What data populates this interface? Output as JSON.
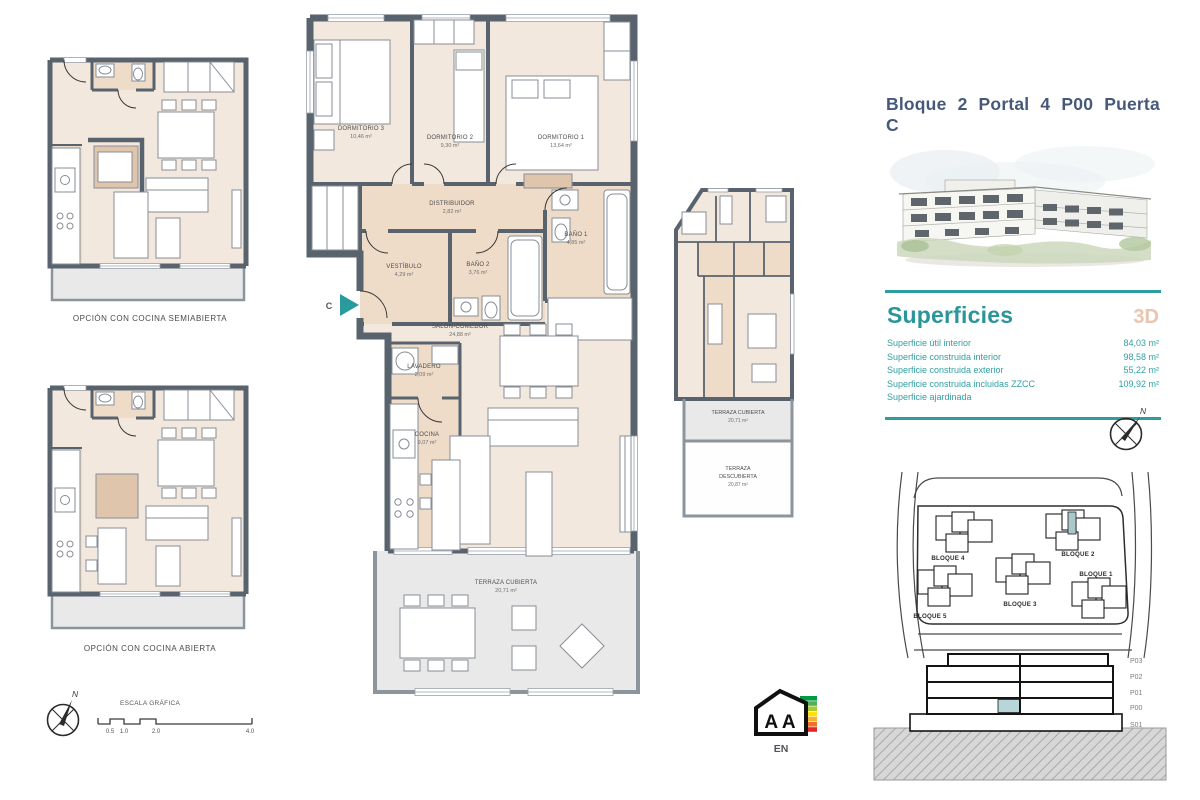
{
  "title": "Bloque 2  Portal 4  P00  Puerta C",
  "colors": {
    "teal": "#2f9da0",
    "title_blue": "#47597b",
    "tag_3d": "#eac5ad",
    "highlight_unit": "#a9c8ca",
    "room_fill": "#f3e8dd"
  },
  "superficies": {
    "heading": "Superficies",
    "tag_3d": "3D",
    "rows": [
      {
        "label": "Superficie útil interior",
        "value": "84,03 m²"
      },
      {
        "label": "Superficie construida interior",
        "value": "98,58 m²"
      },
      {
        "label": "Superficie construida exterior",
        "value": "55,22 m²"
      },
      {
        "label": "Superficie construida incluidas ZZCC",
        "value": "109,92 m²"
      },
      {
        "label": "Superficie ajardinada",
        "value": ""
      }
    ]
  },
  "main_plan": {
    "entrance": "C",
    "rooms": {
      "dormitorio3": {
        "name": "DORMITORIO 3",
        "area": "10,46 m²"
      },
      "dormitorio2": {
        "name": "DORMITORIO 2",
        "area": "9,30 m²"
      },
      "dormitorio1": {
        "name": "DORMITORIO 1",
        "area": "13,64 m²"
      },
      "distribuidor": {
        "name": "DISTRIBUIDOR",
        "area": "2,82 m²"
      },
      "vestibulo": {
        "name": "VESTÍBULO",
        "area": "4,29 m²"
      },
      "bano2": {
        "name": "BAÑO 2",
        "area": "3,76 m²"
      },
      "bano1": {
        "name": "BAÑO 1",
        "area": "4,85 m²"
      },
      "salon": {
        "name": "SALÓN-COMEDOR",
        "area": "24,88 m²"
      },
      "lavadero": {
        "name": "LAVADERO",
        "area": "2,09 m²"
      },
      "cocina": {
        "name": "COCINA",
        "area": "9,07 m²"
      },
      "terraza": {
        "name": "TERRAZA CUBIERTA",
        "area": "20,71 m²"
      }
    }
  },
  "mini_plan": {
    "tc_name": "TERRAZA CUBIERTA",
    "tc_area": "20,71 m²",
    "td_l1": "TERRAZA",
    "td_l2": "DESCUBIERTA",
    "td_area": "20,87 m²"
  },
  "options": {
    "semi": "OPCIÓN CON COCINA SEMIABIERTA",
    "open": "OPCIÓN CON COCINA ABIERTA"
  },
  "scale_bar": {
    "label": "ESCALA GRÁFICA",
    "ticks": [
      "0.5",
      "1.0",
      "2.0",
      "4.0"
    ]
  },
  "compass": {
    "n": "N"
  },
  "site_plan": {
    "blocks": [
      {
        "label": "BLOQUE 4"
      },
      {
        "label": "BLOQUE 2"
      },
      {
        "label": "BLOQUE 5"
      },
      {
        "label": "BLOQUE 3"
      },
      {
        "label": "BLOQUE 1"
      }
    ]
  },
  "section": {
    "levels": [
      "P03",
      "P02",
      "P01",
      "P00",
      "S01"
    ]
  },
  "energy": {
    "letters": "A A",
    "label": "EN"
  }
}
